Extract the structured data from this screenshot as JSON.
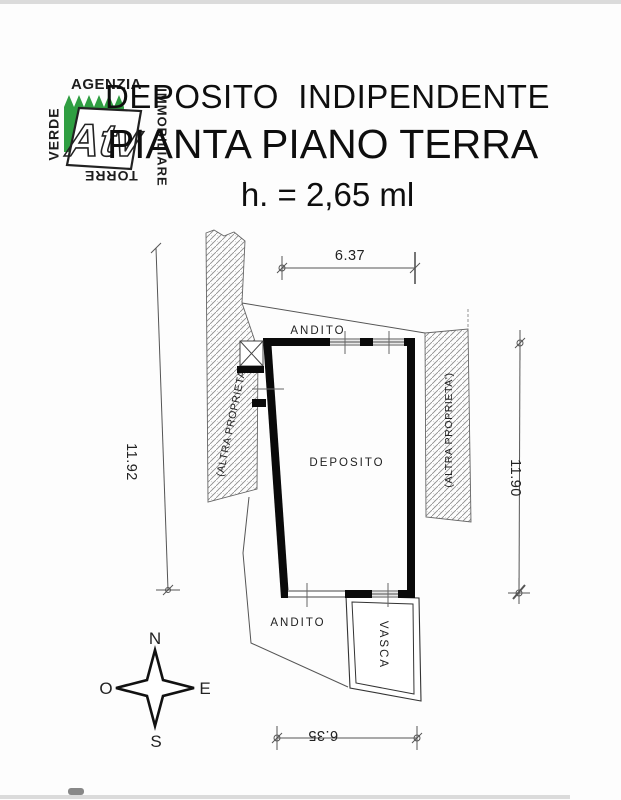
{
  "colors": {
    "logo_green": "#2f9e41",
    "wall": "#0a0a0a",
    "hatch": "#8a8a8a",
    "line": "#555555"
  },
  "logo": {
    "top": "AGENZIA",
    "left": "VERDE",
    "bottom": "TORRE",
    "right": "IMMOBILIARE",
    "mark": "Atv"
  },
  "title": {
    "line1": "DEPOSITO  INDIPENDENTE",
    "line2": "PIANTA PIANO TERRA",
    "height_note": "h. = 2,65 ml"
  },
  "plan": {
    "rooms": {
      "deposito": "DEPOSITO",
      "andito_top": "ANDITO",
      "andito_bottom": "ANDITO",
      "vasca": "VASCA"
    },
    "adjacent": {
      "left": "(ALTRA PROPRIETA')",
      "right": "(ALTRA PROPRIETA')"
    },
    "dimensions": {
      "top": "6.37",
      "left": "11.92",
      "right": "11.90",
      "bottom": "6.35"
    },
    "compass": {
      "n": "N",
      "s": "S",
      "e": "E",
      "w": "O"
    }
  }
}
